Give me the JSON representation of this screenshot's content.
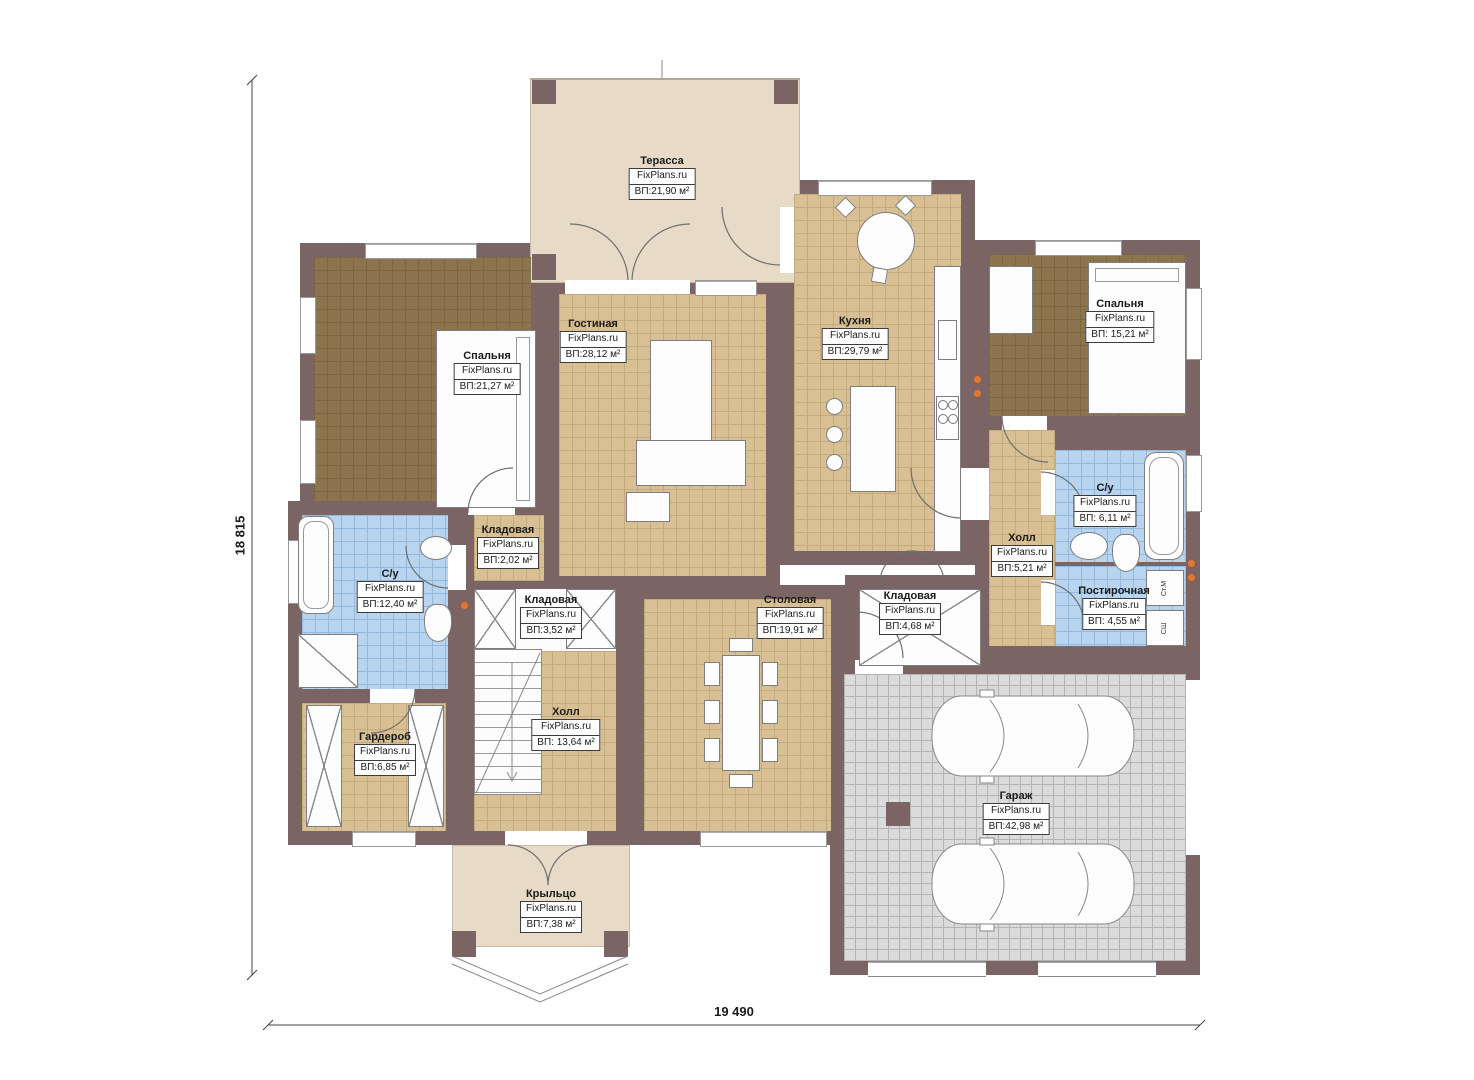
{
  "brand": "FixPlans.ru",
  "dimensions": {
    "height_label": "18 815",
    "width_label": "19 490"
  },
  "rooms": [
    {
      "id": "terrace",
      "name": "Терасса",
      "area": "ВП:21,90 м²"
    },
    {
      "id": "bedroom_left",
      "name": "Спальня",
      "area": "ВП:21,27 м²"
    },
    {
      "id": "living",
      "name": "Гостиная",
      "area": "ВП:28,12 м²"
    },
    {
      "id": "kitchen",
      "name": "Кухня",
      "area": "ВП:29,79 м²"
    },
    {
      "id": "bedroom_right",
      "name": "Спальня",
      "area": "ВП: 15,21 м²"
    },
    {
      "id": "bathroom_right",
      "name": "С/у",
      "area": "ВП: 6,11 м²"
    },
    {
      "id": "hall_right",
      "name": "Холл",
      "area": "ВП:5,21 м²"
    },
    {
      "id": "laundry",
      "name": "Постирочная",
      "area": "ВП: 4,55 м²"
    },
    {
      "id": "bathroom_left",
      "name": "С/у",
      "area": "ВП:12,40 м²"
    },
    {
      "id": "storage_small",
      "name": "Кладовая",
      "area": "ВП:2,02 м²"
    },
    {
      "id": "storage_stairs",
      "name": "Кладовая",
      "area": "ВП:3,52 м²"
    },
    {
      "id": "dining",
      "name": "Столовая",
      "area": "ВП:19,91 м²"
    },
    {
      "id": "storage_mid",
      "name": "Кладовая",
      "area": "ВП:4,68 м²"
    },
    {
      "id": "hall_main",
      "name": "Холл",
      "area": "ВП: 13,64 м²"
    },
    {
      "id": "wardrobe",
      "name": "Гардероб",
      "area": "ВП:6,85 м²"
    },
    {
      "id": "garage",
      "name": "Гараж",
      "area": "ВП:42,98 м²"
    },
    {
      "id": "porch",
      "name": "Крыльцо",
      "area": "ВП:7,38 м²"
    }
  ],
  "appliances": {
    "washer": "Ст.М",
    "dryer": "СШ"
  },
  "colors": {
    "wall": "#7a6464",
    "floor_tan": "#d8c094",
    "floor_dark": "#8c744e",
    "floor_blue": "#b8d4ef",
    "floor_gray": "#dbdbdb",
    "floor_beige": "#e7dac7",
    "accent_orange": "#e8762a"
  }
}
